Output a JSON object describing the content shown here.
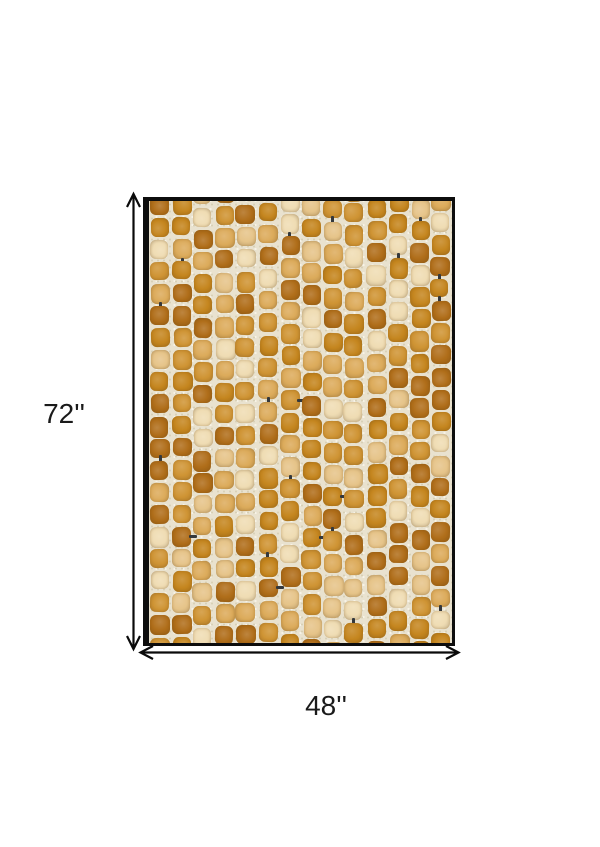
{
  "diagram": {
    "height_label": "72''",
    "width_label": "48''",
    "line_color": "#0a0a0a",
    "label_color": "#1a1a1a"
  },
  "rug": {
    "border_color": "#0d0d0d",
    "base_color": "#e9e2cf",
    "speckle_dark": "#d8d0b6",
    "speckle_light": "#f7f3e7",
    "connector_color": "#34383c",
    "tile_palette": [
      "#b06e1a",
      "#c5861f",
      "#cf9434",
      "#dcab5b",
      "#e6c489",
      "#efdcb3"
    ],
    "tile_weights": [
      0.2,
      0.17,
      0.17,
      0.16,
      0.15,
      0.15
    ],
    "grid": {
      "columns": 14,
      "rows": 21,
      "seed": 20,
      "connector_chance": 0.05
    }
  }
}
